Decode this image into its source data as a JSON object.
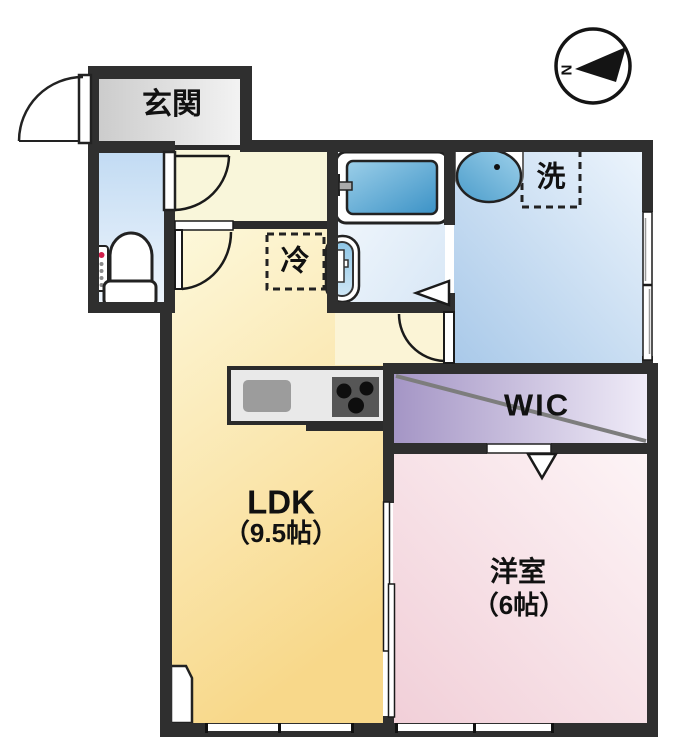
{
  "compass": {
    "north_label": "N"
  },
  "rooms": {
    "genkan": {
      "label": "玄関"
    },
    "ldk": {
      "label": "LDK",
      "size": "（9.5帖）"
    },
    "western_room": {
      "label": "洋室",
      "size": "（6帖）"
    },
    "wic": {
      "label": "WIC"
    }
  },
  "appliances": {
    "refrigerator_label": "冷",
    "washer_label": "洗"
  },
  "palette": {
    "wall": "#2f2f2f",
    "genkan_floor": "#d9d9d9",
    "hall_floor": "#f9f6da",
    "ldk_floor_light": "#fdf9dd",
    "ldk_floor_deep": "#f8d88a",
    "toilet_floor": "#c2dbf3",
    "bath_floor": "#dce9f7",
    "washroom_floor_light": "#ecf4fc",
    "washroom_floor_deep": "#a9c9e9",
    "wic_floor_deep": "#a495c5",
    "wic_floor_light": "#f0ecf8",
    "western_floor_deep": "#f1cfd8",
    "western_floor_light": "#fdf4f6",
    "tub_blue": "#3b92c6",
    "text": "#111111"
  }
}
